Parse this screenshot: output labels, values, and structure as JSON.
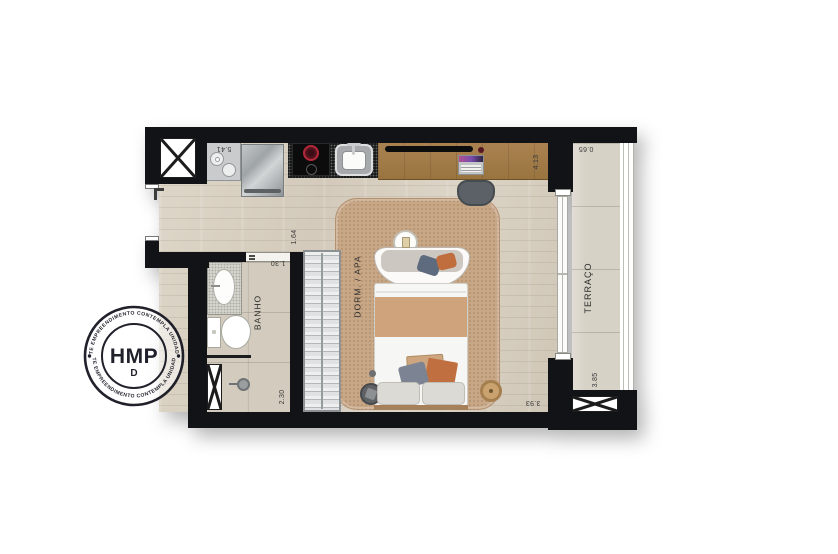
{
  "stamp": {
    "brand": "HMP",
    "mark": "D",
    "arc_top": "ESTE EMPREENDIMENTO CONTEMPLA UNIDADES",
    "arc_bottom": "ESTE EMPREENDIMENTO CONTEMPLA UNIDADES"
  },
  "plan": {
    "rooms": {
      "bathroom": "BANHO",
      "bedroom": "DORM. / APA",
      "terrace": "TERRAÇO"
    },
    "dimensions": {
      "kitchen_run": "5.41",
      "desk_wall": "4.13",
      "terrace_depth": "0.65",
      "hall_width": "1.64",
      "bath_door": "1.30",
      "bath_length": "2.30",
      "bedroom_width": "3.93",
      "terrace_length": "3.85"
    },
    "colors": {
      "wall": "#121316",
      "wood_floor": "#d8d0c2",
      "rug": "#c8a787",
      "blanket": "#cfa37b",
      "accent_orange": "#c06e3e",
      "accent_blue": "#5e6a7d",
      "desk_wood": "#a07a49"
    }
  }
}
